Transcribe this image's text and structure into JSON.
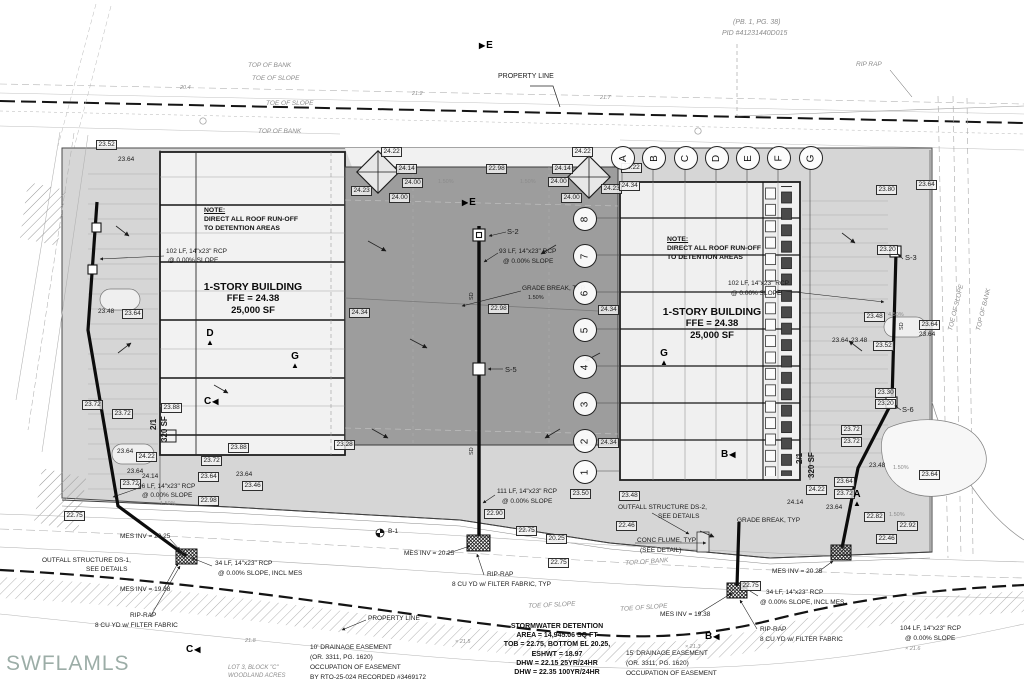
{
  "meta": {
    "watermark": "SWFLAMLS",
    "plat_ref": "(PB. 1, PG. 38)",
    "pid": "PID #41231440D015"
  },
  "grid": {
    "columns": [
      {
        "label": "A",
        "x": 622
      },
      {
        "label": "B",
        "x": 653
      },
      {
        "label": "C",
        "x": 685
      },
      {
        "label": "D",
        "x": 716
      },
      {
        "label": "E",
        "x": 747
      },
      {
        "label": "F",
        "x": 778
      },
      {
        "label": "G",
        "x": 810
      }
    ],
    "columns_y": 157,
    "rows": [
      {
        "label": "8",
        "y": 218
      },
      {
        "label": "7",
        "y": 255
      },
      {
        "label": "6",
        "y": 292
      },
      {
        "label": "5",
        "y": 329
      },
      {
        "label": "4",
        "y": 366
      },
      {
        "label": "3",
        "y": 403
      },
      {
        "label": "2",
        "y": 440
      },
      {
        "label": "1",
        "y": 471
      }
    ],
    "rows_x": 584
  },
  "buildings": {
    "left": {
      "note1": "NOTE:",
      "note2": "DIRECT ALL ROOF RUN-OFF",
      "note3": "TO DETENTION AREAS",
      "title": "1-STORY BUILDING",
      "ffe": "FFE = 24.38",
      "area": "25,000 SF"
    },
    "right": {
      "note1": "NOTE:",
      "note2": "DIRECT ALL ROOF RUN-OFF",
      "note3": "TO DETENTION AREAS",
      "title": "1-STORY BUILDING",
      "ffe": "FFE = 24.38",
      "area": "25,000 SF"
    }
  },
  "stormwater": {
    "title": "STORMWATER DETENTION",
    "lines": [
      "AREA = 14,945.06 SQ FT",
      "TOB = 22.75, BOTTOM EL 20.25,",
      "ESHWT = 18.97",
      "DHW = 22.15 25YR/24HR",
      "DHW = 22.35 100YR/24HR"
    ]
  },
  "sections": [
    {
      "letter": "E",
      "x": 479,
      "y": 40,
      "dir": "right"
    },
    {
      "letter": "E",
      "x": 462,
      "y": 197,
      "dir": "right"
    },
    {
      "letter": "D",
      "x": 206,
      "y": 328,
      "dir": "up"
    },
    {
      "letter": "G",
      "x": 291,
      "y": 351,
      "dir": "up"
    },
    {
      "letter": "C",
      "x": 204,
      "y": 396,
      "dir": "left"
    },
    {
      "letter": "G",
      "x": 660,
      "y": 348,
      "dir": "up"
    },
    {
      "letter": "B",
      "x": 721,
      "y": 449,
      "dir": "left"
    },
    {
      "letter": "A",
      "x": 853,
      "y": 489,
      "dir": "up"
    },
    {
      "letter": "B",
      "x": 705,
      "y": 631,
      "dir": "left"
    },
    {
      "letter": "C",
      "x": 186,
      "y": 644,
      "dir": "left"
    }
  ],
  "labels": [
    {
      "t": "(PB. 1, PG. 38)",
      "x": 733,
      "y": 19,
      "i": 1,
      "c": "g",
      "s": 7
    },
    {
      "t": "PID #41231440D015",
      "x": 722,
      "y": 30,
      "i": 1,
      "c": "g",
      "s": 7
    },
    {
      "t": "TOP OF BANK",
      "x": 248,
      "y": 63,
      "i": 1,
      "c": "g"
    },
    {
      "t": "TOE OF SLOPE",
      "x": 252,
      "y": 76,
      "i": 1,
      "c": "g"
    },
    {
      "t": "TOE OF SLOPE",
      "x": 266,
      "y": 101,
      "i": 1,
      "c": "g"
    },
    {
      "t": "TOP OF BANK",
      "x": 258,
      "y": 129,
      "i": 1,
      "c": "g"
    },
    {
      "t": "PROPERTY LINE",
      "x": 498,
      "y": 73,
      "s": 7
    },
    {
      "t": "RIP RAP",
      "x": 856,
      "y": 62,
      "i": 1,
      "c": "g"
    },
    {
      "t": "20.4",
      "x": 180,
      "y": 86,
      "i": 1,
      "c": "g",
      "s": 5.5
    },
    {
      "t": "21.2",
      "x": 412,
      "y": 92,
      "i": 1,
      "c": "g",
      "s": 5.5
    },
    {
      "t": "21.7",
      "x": 600,
      "y": 96,
      "i": 1,
      "c": "g",
      "s": 5.5
    },
    {
      "t": "23.52",
      "x": 96,
      "y": 140,
      "box": 1
    },
    {
      "t": "23.64",
      "x": 118,
      "y": 157
    },
    {
      "t": "23.48",
      "x": 98,
      "y": 309
    },
    {
      "t": "23.64",
      "x": 122,
      "y": 309,
      "box": 1
    },
    {
      "t": "102 LF, 14\"x23\" RCP",
      "x": 166,
      "y": 249
    },
    {
      "t": "@ 0.00% SLOPE",
      "x": 168,
      "y": 258
    },
    {
      "t": "SD",
      "x": 470,
      "y": 300,
      "r": -90,
      "s": 5.5
    },
    {
      "t": "SD",
      "x": 470,
      "y": 455,
      "r": -90,
      "s": 5.5
    },
    {
      "t": "SD",
      "x": 900,
      "y": 330,
      "r": -90,
      "s": 5.5
    },
    {
      "t": "23.72",
      "x": 82,
      "y": 400,
      "box": 1
    },
    {
      "t": "23.72",
      "x": 112,
      "y": 409,
      "box": 1
    },
    {
      "t": "23.88",
      "x": 161,
      "y": 403,
      "box": 1
    },
    {
      "t": "23.64",
      "x": 117,
      "y": 449
    },
    {
      "t": "24.22",
      "x": 136,
      "y": 452,
      "box": 1
    },
    {
      "t": "23.72",
      "x": 201,
      "y": 456,
      "box": 1
    },
    {
      "t": "23.88",
      "x": 228,
      "y": 443,
      "box": 1
    },
    {
      "t": "23.64",
      "x": 127,
      "y": 469
    },
    {
      "t": "24.14",
      "x": 142,
      "y": 474
    },
    {
      "t": "23.64",
      "x": 198,
      "y": 472,
      "box": 1
    },
    {
      "t": "23.72",
      "x": 120,
      "y": 479,
      "box": 1
    },
    {
      "t": "96 LF, 14\"x23\" RCP",
      "x": 138,
      "y": 484
    },
    {
      "t": "@ 0.00% SLOPE",
      "x": 142,
      "y": 493
    },
    {
      "t": "1.50%",
      "x": 160,
      "y": 502,
      "s": 5.5,
      "c": "g"
    },
    {
      "t": "22.98",
      "x": 198,
      "y": 496,
      "box": 1
    },
    {
      "t": "23.64",
      "x": 236,
      "y": 472
    },
    {
      "t": "23.46",
      "x": 242,
      "y": 481,
      "box": 1
    },
    {
      "t": "22.75",
      "x": 64,
      "y": 511,
      "box": 1
    },
    {
      "t": "2/1",
      "x": 150,
      "y": 430,
      "r": -90,
      "s": 8,
      "b": 1
    },
    {
      "t": "320 SF",
      "x": 161,
      "y": 442,
      "r": -90,
      "s": 8,
      "b": 1
    },
    {
      "t": "24.22",
      "x": 381,
      "y": 147,
      "box": 1
    },
    {
      "t": "24.14",
      "x": 396,
      "y": 164,
      "box": 1
    },
    {
      "t": "24.00",
      "x": 402,
      "y": 178,
      "box": 1
    },
    {
      "t": "24.00",
      "x": 389,
      "y": 193,
      "box": 1
    },
    {
      "t": "22.98",
      "x": 486,
      "y": 164,
      "box": 1
    },
    {
      "t": "24.22",
      "x": 572,
      "y": 147,
      "box": 1
    },
    {
      "t": "24.14",
      "x": 552,
      "y": 164,
      "box": 1
    },
    {
      "t": "24.00",
      "x": 548,
      "y": 177,
      "box": 1
    },
    {
      "t": "24.00",
      "x": 561,
      "y": 193,
      "box": 1
    },
    {
      "t": "24.23",
      "x": 351,
      "y": 186,
      "box": 1
    },
    {
      "t": "24.23",
      "x": 601,
      "y": 184,
      "box": 1
    },
    {
      "t": "24.22",
      "x": 621,
      "y": 163,
      "box": 1
    },
    {
      "t": "24.34",
      "x": 619,
      "y": 181,
      "box": 1
    },
    {
      "t": "1.50%",
      "x": 438,
      "y": 180,
      "s": 5.5,
      "c": "g"
    },
    {
      "t": "1.50%",
      "x": 520,
      "y": 180,
      "s": 5.5,
      "c": "g"
    },
    {
      "t": "S-2",
      "x": 507,
      "y": 228,
      "s": 7.5
    },
    {
      "t": "93 LF, 14\"x23\" RCP",
      "x": 499,
      "y": 249
    },
    {
      "t": "@ 0.00% SLOPE",
      "x": 503,
      "y": 259
    },
    {
      "t": "GRADE BREAK, TYP",
      "x": 522,
      "y": 286
    },
    {
      "t": "1.50%",
      "x": 528,
      "y": 296,
      "s": 5.5
    },
    {
      "t": "24.34",
      "x": 349,
      "y": 308,
      "box": 1
    },
    {
      "t": "22.98",
      "x": 488,
      "y": 304,
      "box": 1
    },
    {
      "t": "24.34",
      "x": 598,
      "y": 305,
      "box": 1
    },
    {
      "t": "S-5",
      "x": 505,
      "y": 366,
      "s": 7.5
    },
    {
      "t": "24.34",
      "x": 598,
      "y": 438,
      "box": 1
    },
    {
      "t": "23.28",
      "x": 334,
      "y": 440,
      "box": 1
    },
    {
      "t": "102 LF, 14\"x23\" RCP",
      "x": 728,
      "y": 281
    },
    {
      "t": "@ 0.00% SLOPE",
      "x": 731,
      "y": 291
    },
    {
      "t": "23.80",
      "x": 876,
      "y": 185,
      "box": 1
    },
    {
      "t": "23.64",
      "x": 916,
      "y": 180,
      "box": 1
    },
    {
      "t": "23.20",
      "x": 877,
      "y": 245,
      "box": 1
    },
    {
      "t": "S-3",
      "x": 905,
      "y": 254,
      "s": 7.5
    },
    {
      "t": "23.48",
      "x": 864,
      "y": 312,
      "box": 1
    },
    {
      "t": "4.50%",
      "x": 888,
      "y": 313,
      "s": 5.5,
      "c": "g"
    },
    {
      "t": "23.64",
      "x": 919,
      "y": 320,
      "box": 1
    },
    {
      "t": "23.64",
      "x": 919,
      "y": 332
    },
    {
      "t": "23.64",
      "x": 832,
      "y": 338
    },
    {
      "t": "23.48",
      "x": 851,
      "y": 338
    },
    {
      "t": "23.52",
      "x": 873,
      "y": 341,
      "box": 1
    },
    {
      "t": "23.30",
      "x": 875,
      "y": 388,
      "box": 1
    },
    {
      "t": "23.20",
      "x": 875,
      "y": 399,
      "box": 1
    },
    {
      "t": "S-6",
      "x": 902,
      "y": 406,
      "s": 7.5
    },
    {
      "t": "23.72",
      "x": 841,
      "y": 425,
      "box": 1
    },
    {
      "t": "23.72",
      "x": 841,
      "y": 437,
      "box": 1
    },
    {
      "t": "23.48",
      "x": 869,
      "y": 463
    },
    {
      "t": "1.50%",
      "x": 893,
      "y": 466,
      "s": 5.5,
      "c": "g"
    },
    {
      "t": "23.64",
      "x": 919,
      "y": 470,
      "box": 1
    },
    {
      "t": "23.64",
      "x": 834,
      "y": 477,
      "box": 1
    },
    {
      "t": "23.72",
      "x": 834,
      "y": 489,
      "box": 1
    },
    {
      "t": "24.22",
      "x": 806,
      "y": 485,
      "box": 1
    },
    {
      "t": "24.14",
      "x": 787,
      "y": 500
    },
    {
      "t": "23.64",
      "x": 826,
      "y": 505
    },
    {
      "t": "22.82",
      "x": 864,
      "y": 512,
      "box": 1
    },
    {
      "t": "1.50%",
      "x": 889,
      "y": 513,
      "s": 5.5,
      "c": "g"
    },
    {
      "t": "22.92",
      "x": 897,
      "y": 521,
      "box": 1
    },
    {
      "t": "22.46",
      "x": 876,
      "y": 534,
      "box": 1
    },
    {
      "t": "2/1",
      "x": 796,
      "y": 464,
      "r": -90,
      "s": 8,
      "b": 1
    },
    {
      "t": "320 SF",
      "x": 808,
      "y": 478,
      "r": -90,
      "s": 8,
      "b": 1
    },
    {
      "t": "GRADE BREAK, TYP",
      "x": 737,
      "y": 518
    },
    {
      "t": "TOE OF SLOPE",
      "x": 948,
      "y": 330,
      "r": -76,
      "i": 1,
      "c": "g"
    },
    {
      "t": "TOP OF BANK",
      "x": 976,
      "y": 330,
      "r": -76,
      "i": 1,
      "c": "g"
    },
    {
      "t": "23.48",
      "x": 619,
      "y": 491,
      "box": 1
    },
    {
      "t": "111 LF, 14\"x23\" RCP",
      "x": 497,
      "y": 489
    },
    {
      "t": "23.50",
      "x": 570,
      "y": 489,
      "box": 1
    },
    {
      "t": "@ 0.00% SLOPE",
      "x": 502,
      "y": 499
    },
    {
      "t": "22.90",
      "x": 484,
      "y": 509,
      "box": 1
    },
    {
      "t": "OUTFALL STRUCTURE DS-2,",
      "x": 618,
      "y": 505
    },
    {
      "t": "SEE DETAILS",
      "x": 658,
      "y": 514
    },
    {
      "t": "22.46",
      "x": 616,
      "y": 521,
      "box": 1
    },
    {
      "t": "22.75",
      "x": 516,
      "y": 526,
      "box": 1
    },
    {
      "t": "20.25",
      "x": 546,
      "y": 534,
      "box": 1
    },
    {
      "t": "22.75",
      "x": 548,
      "y": 558,
      "box": 1
    },
    {
      "t": "B-1",
      "x": 388,
      "y": 529,
      "s": 6.5
    },
    {
      "t": "MES INV = 20.25",
      "x": 404,
      "y": 551
    },
    {
      "t": "MES INV = 20.25",
      "x": 120,
      "y": 534
    },
    {
      "t": "OUTFALL STRUCTURE DS-1,",
      "x": 42,
      "y": 558
    },
    {
      "t": "SEE DETAILS",
      "x": 86,
      "y": 567
    },
    {
      "t": "34 LF, 14\"x23\" RCP",
      "x": 215,
      "y": 561
    },
    {
      "t": "@ 0.00% SLOPE, INCL MES",
      "x": 218,
      "y": 571
    },
    {
      "t": "MES INV = 19.38",
      "x": 120,
      "y": 587
    },
    {
      "t": "RIP-RAP",
      "x": 130,
      "y": 613
    },
    {
      "t": "8 CU YD w/ FILTER FABRIC",
      "x": 95,
      "y": 623
    },
    {
      "t": "RIP-RAP",
      "x": 487,
      "y": 572
    },
    {
      "t": "8 CU YD w/ FILTER FABRIC, TYP",
      "x": 452,
      "y": 582
    },
    {
      "t": "CONC FLUME, TYP",
      "x": 637,
      "y": 538
    },
    {
      "t": "(SEE DETAIL)",
      "x": 640,
      "y": 548
    },
    {
      "t": "TOP OF BANK",
      "x": 625,
      "y": 561,
      "i": 1,
      "c": "g",
      "r": -4
    },
    {
      "t": "TOE OF SLOPE",
      "x": 528,
      "y": 604,
      "i": 1,
      "c": "g",
      "r": -3
    },
    {
      "t": "TOE OF SLOPE",
      "x": 620,
      "y": 607,
      "i": 1,
      "c": "g",
      "r": -4
    },
    {
      "t": "MES INV = 20.25",
      "x": 772,
      "y": 569
    },
    {
      "t": "22.75",
      "x": 740,
      "y": 581,
      "box": 1
    },
    {
      "t": "34 LF, 14\"x23\" RCP",
      "x": 766,
      "y": 590
    },
    {
      "t": "@ 0.00% SLOPE, INCL MES",
      "x": 760,
      "y": 600
    },
    {
      "t": "MES INV = 19.38",
      "x": 660,
      "y": 612
    },
    {
      "t": "RIP-RAP",
      "x": 760,
      "y": 627
    },
    {
      "t": "8 CU YD w/ FILTER FABRIC",
      "x": 760,
      "y": 637
    },
    {
      "t": "104 LF, 14\"x23\" RCP",
      "x": 900,
      "y": 626
    },
    {
      "t": "@ 0.00% SLOPE",
      "x": 905,
      "y": 636
    },
    {
      "t": "PROPERTY LINE",
      "x": 368,
      "y": 616
    },
    {
      "t": "10' DRAINAGE EASEMENT",
      "x": 310,
      "y": 645
    },
    {
      "t": "(OR. 3311, PG. 1620)",
      "x": 310,
      "y": 655
    },
    {
      "t": "OCCUPATION OF EASEMENT",
      "x": 310,
      "y": 665
    },
    {
      "t": "BY RTO-25-024 RECORDED #3469172",
      "x": 310,
      "y": 675
    },
    {
      "t": "15' DRAINAGE EASEMENT",
      "x": 626,
      "y": 651
    },
    {
      "t": "(OR. 3311, PG. 1620)",
      "x": 626,
      "y": 661
    },
    {
      "t": "OCCUPATION OF EASEMENT",
      "x": 626,
      "y": 671
    },
    {
      "t": "LOT 3, BLOCK \"C\"",
      "x": 228,
      "y": 665,
      "i": 1,
      "c": "g",
      "s": 6
    },
    {
      "t": "WOODLAND ACRES",
      "x": 228,
      "y": 673,
      "i": 1,
      "c": "g",
      "s": 6
    },
    {
      "t": "21.8",
      "x": 245,
      "y": 639,
      "i": 1,
      "c": "g",
      "s": 5.5
    },
    {
      "t": "× 21.5",
      "x": 455,
      "y": 640,
      "i": 1,
      "c": "g",
      "s": 5.5
    },
    {
      "t": "× 21.3",
      "x": 685,
      "y": 645,
      "i": 1,
      "c": "g",
      "s": 5.5
    },
    {
      "t": "× 21.6",
      "x": 905,
      "y": 647,
      "i": 1,
      "c": "g",
      "s": 5.5
    }
  ]
}
